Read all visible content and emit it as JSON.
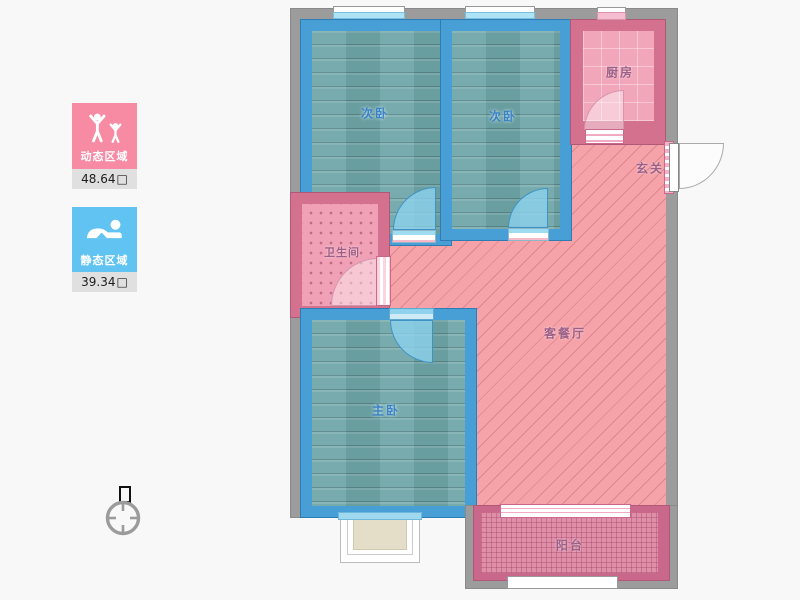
{
  "legend": {
    "dynamic": {
      "title": "动态区域",
      "area": "48.64",
      "unit": "□"
    },
    "static": {
      "title": "静态区域",
      "area": "39.34",
      "unit": "□"
    }
  },
  "rooms": {
    "bedroom_top_left": {
      "label": "次卧"
    },
    "bedroom_top_right": {
      "label": "次卧"
    },
    "kitchen": {
      "label": "厨房"
    },
    "entrance": {
      "label": "玄关"
    },
    "bathroom": {
      "label": "卫生间"
    },
    "living_dining": {
      "label": "客餐厅"
    },
    "master_bedroom": {
      "label": "主卧"
    },
    "balcony": {
      "label": "阳台"
    }
  },
  "colors": {
    "dynamic_card": "#f78ba4",
    "static_card": "#60c3f1",
    "value_strip": "#e0e0e0",
    "bedroom_wall_blue": "#479fd6",
    "pink_wall": "#d4718f",
    "dark_pink_wall": "#c9688b",
    "outer_wall_gray": "#9c9c9c",
    "wood_floor_teal": "#6fa6a8",
    "living_floor_pink": "#f5a3a8",
    "door_arc_blue": "#8dd3f0",
    "bay_window_fill": "#e4ddc8",
    "background": "#f8f8f8"
  }
}
